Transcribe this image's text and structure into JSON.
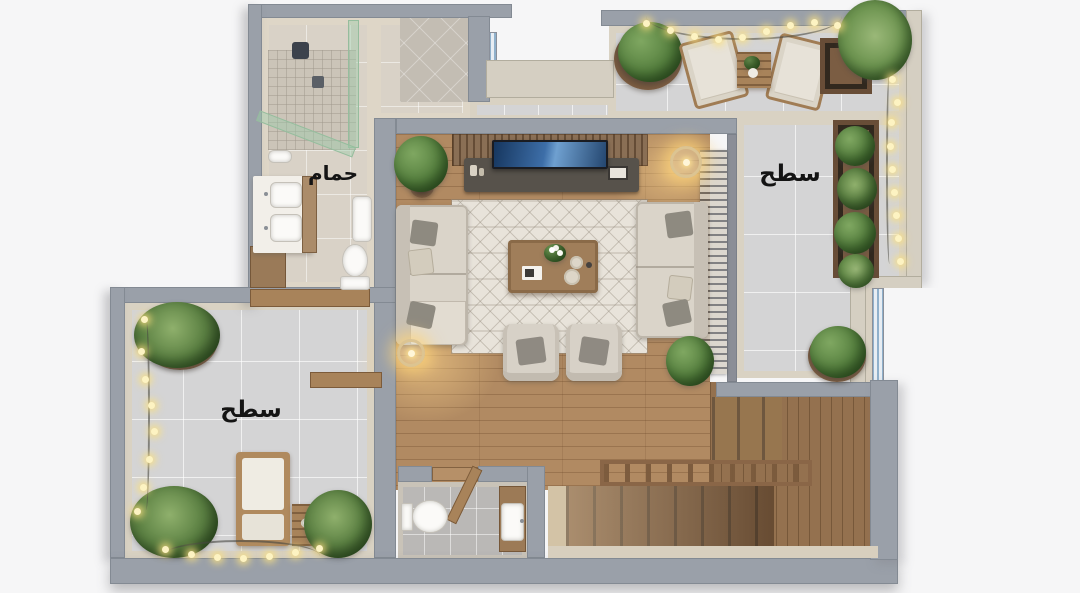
{
  "labels": {
    "bathroom": "حمام",
    "terrace_right": "سطح",
    "terrace_left": "سطح"
  },
  "palette": {
    "background": "#f6f6f7",
    "wall_gray": "#9aa0a9",
    "wall_cream": "#d5cfc2",
    "wall_inner_face": "#d8d0c1",
    "terrace_tile": "#d4d4d5",
    "bathroom_tile": "#d9d2c7",
    "wood_floor": "#b18a62",
    "stair_wood": "#94714f",
    "rug": "#e8e3da",
    "sofa": "#dad4c9",
    "plant_green": "#56803f",
    "planter_wood": "#7b5d43",
    "string_light": "#fdf3c2",
    "tv_screen": "#2e4f7d",
    "shower_glass": "#9ecdaa",
    "label_text": "#141414"
  }
}
